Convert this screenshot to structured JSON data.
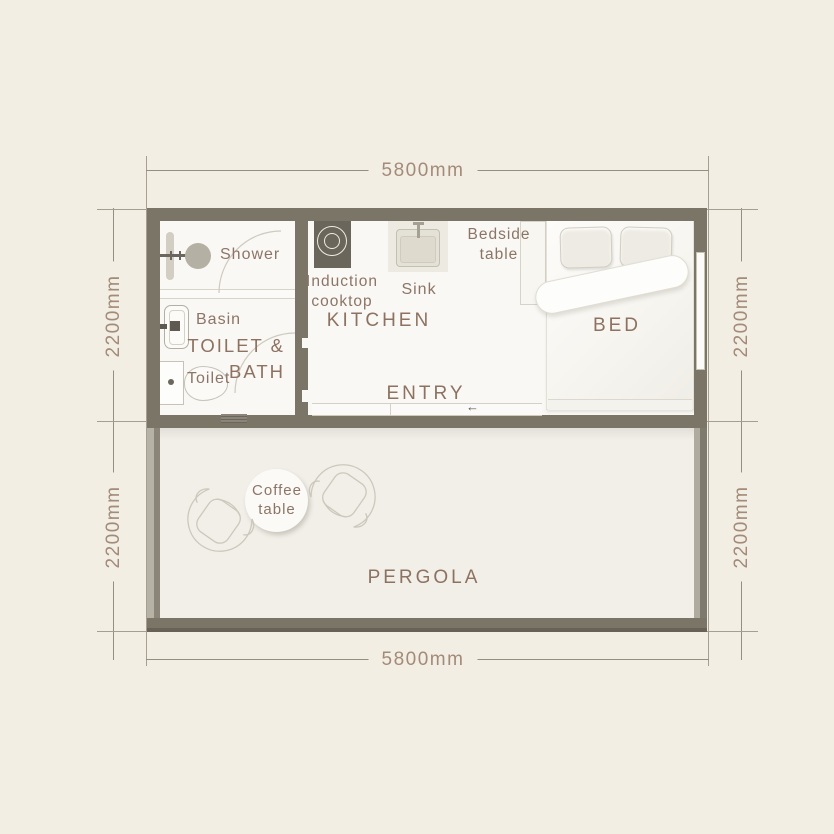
{
  "dimensions": {
    "top": "5800mm",
    "bottom": "5800mm",
    "left_upper": "2200mm",
    "left_lower": "2200mm",
    "right_upper": "2200mm",
    "right_lower": "2200mm"
  },
  "rooms": {
    "toilet_bath_line1": "TOILET &",
    "toilet_bath_line2": "BATH",
    "kitchen": "KITCHEN",
    "entry": "ENTRY",
    "bed": "BED",
    "pergola": "PERGOLA"
  },
  "fixtures": {
    "shower": "Shower",
    "basin": "Basin",
    "toilet": "Toilet",
    "induction_line1": "Induction",
    "induction_line2": "cooktop",
    "sink": "Sink",
    "bedside_line1": "Bedside",
    "bedside_line2": "table",
    "coffee_line1": "Coffee",
    "coffee_line2": "table"
  },
  "icons": {
    "entry_arrow": "←"
  },
  "colors": {
    "background": "#f3eee4",
    "wall": "#7b7567",
    "indoor_floor": "#f9f8f4",
    "pergola_floor": "#f1efe8",
    "room_label": "#8d7261",
    "fixture_label": "#8c7567",
    "dimension_text": "#a28b78",
    "dimension_line": "#958f82",
    "cooktop": "#6a665c",
    "fixture_dark": "#5e5a52"
  }
}
